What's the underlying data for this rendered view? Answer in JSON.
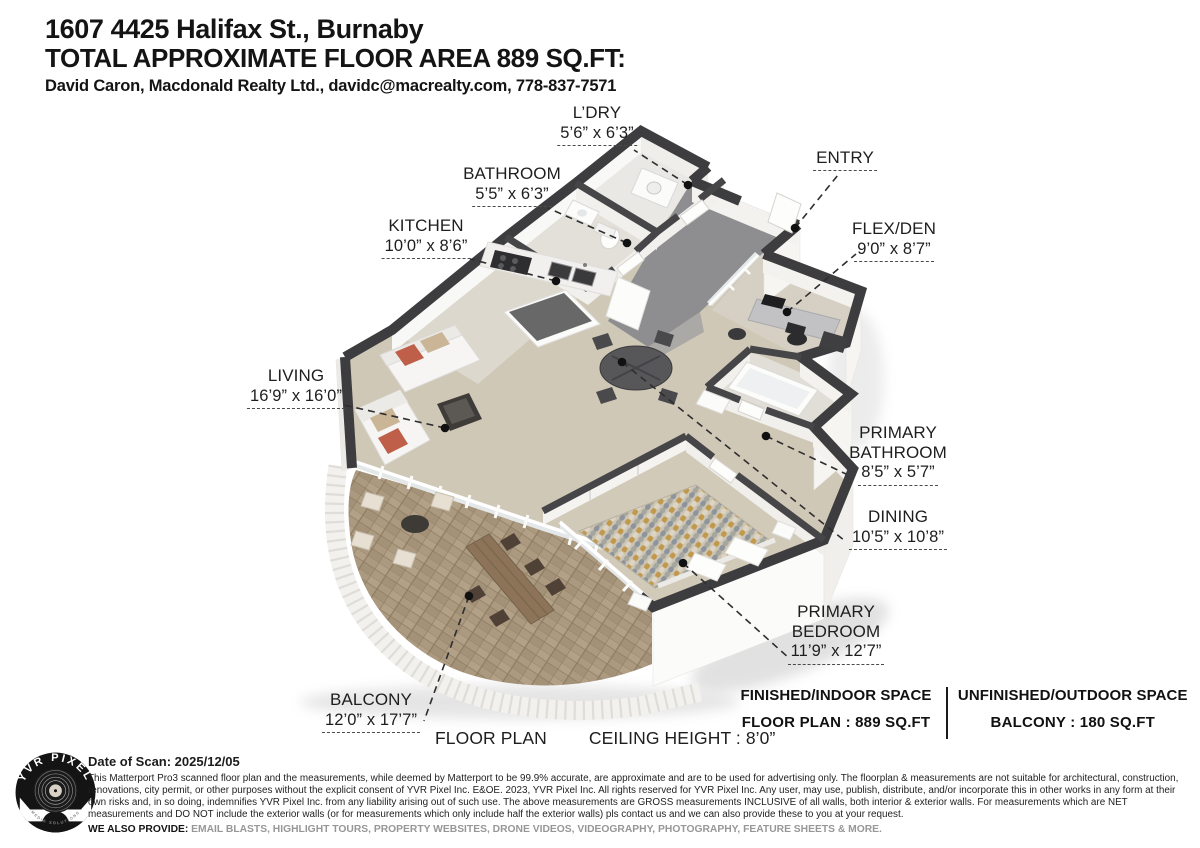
{
  "header": {
    "address": "1607 4425 Halifax St., Burnaby",
    "area_title": "TOTAL APPROXIMATE FLOOR AREA 889 SQ.FT:",
    "agent": "David Caron, Macdonald Realty Ltd., davidc@macrealty.com, 778-837-7571"
  },
  "rooms": [
    {
      "id": "laundry",
      "name": "L’DRY",
      "dims": "5’6” x 6’3”"
    },
    {
      "id": "bathroom",
      "name": "BATHROOM",
      "dims": "5’5” x 6’3”"
    },
    {
      "id": "kitchen",
      "name": "KITCHEN",
      "dims": "10’0” x 8’6”"
    },
    {
      "id": "entry",
      "name": "ENTRY",
      "dims": ""
    },
    {
      "id": "flex-den",
      "name": "FLEX/DEN",
      "dims": "9’0” x 8’7”"
    },
    {
      "id": "living",
      "name": "LIVING",
      "dims": "16’9” x 16’0”"
    },
    {
      "id": "primary-bathroom",
      "name": "PRIMARY BATHROOM",
      "dims": "8’5” x 5’7”"
    },
    {
      "id": "dining",
      "name": "DINING",
      "dims": "10’5” x 10’8”"
    },
    {
      "id": "primary-bedroom",
      "name": "PRIMARY BEDROOM",
      "dims": "11’9” x 12’7”"
    },
    {
      "id": "balcony",
      "name": "BALCONY",
      "dims": "12’0” x 17’7”"
    }
  ],
  "caption": {
    "floor_plan": "FLOOR PLAN",
    "ceiling": "CEILING HEIGHT : 8’0”"
  },
  "summary": {
    "indoor_title": "FINISHED/INDOOR SPACE",
    "indoor_value": "FLOOR PLAN  :  889 SQ.FT",
    "outdoor_title": "UNFINISHED/OUTDOOR SPACE",
    "outdoor_value": "BALCONY  :  180 SQ.FT"
  },
  "footer": {
    "logo_brand": "YVR PIXEL",
    "logo_sub": "MEDIA SOLUTIONS",
    "scan_date": "Date of Scan: 2025/12/05",
    "disclaimer": "This Matterport Pro3 scanned floor plan and the measurements, while deemed by Matterport to be 99.9% accurate, are approximate and are to be used for advertising only. The floorplan & measurements are not suitable for architectural, construction, renovations, city permit, or other purposes without the explicit consent of YVR Pixel Inc. E&OE. 2023, YVR Pixel Inc. All rights reserved for YVR Pixel Inc. Any user, may use, publish, distribute, and/or incorporate this in other works in any form at their own risks and, in so doing, indemnifies YVR Pixel Inc. from any liability arising out of such use. The above measurements are GROSS measurements INCLUSIVE of all walls, both interior & exterior walls. For measurements which are NET measurements and DO NOT include the exterior walls (or for measurements which only include half the exterior walls) pls contact us and we can also provide these to you at your request.",
    "also_provide_label": "WE ALSO PROVIDE:",
    "also_provide_items": " EMAIL BLASTS, HIGHLIGHT TOURS, PROPERTY WEBSITES, DRONE VIDEOS, VIDEOGRAPHY, PHOTOGRAPHY, FEATURE SHEETS & MORE."
  },
  "colors": {
    "wall_top": "#3d3c3e",
    "floor_main": "#d0c8b7",
    "floor_hall": "#8e8e90",
    "balcony_tile": "#ab9980",
    "accent_cushion": "#bf5f49"
  }
}
